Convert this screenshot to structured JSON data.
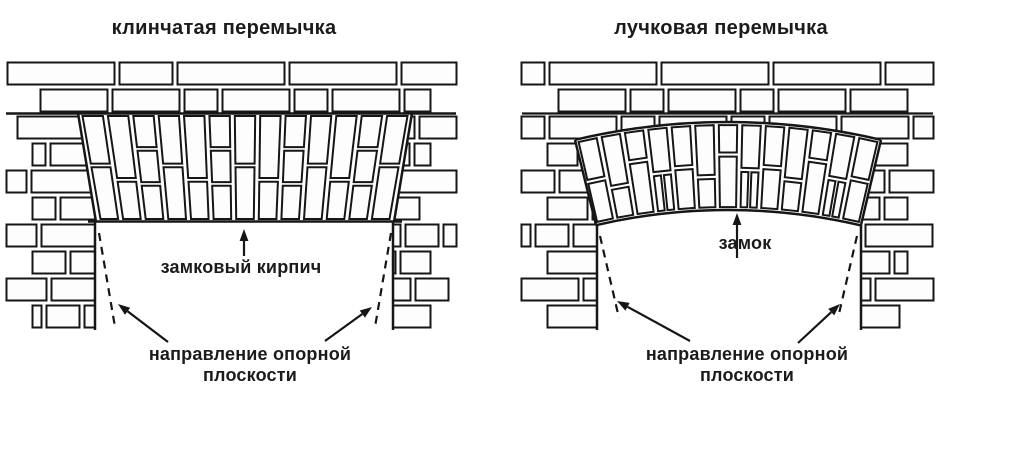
{
  "figure": {
    "background": "#ffffff",
    "line_color": "#161616",
    "brick_fill": "#fdfdfd",
    "text_color": "#1b1b1b"
  },
  "panels": [
    {
      "id": "wedge",
      "title": "клинчатая перемычка",
      "keystone_label": "замковый кирпич",
      "bearing_label": "направление опорной плоскости"
    },
    {
      "id": "segmental",
      "title": "лучковая перемычка",
      "keystone_label": "замок",
      "bearing_label": "направление опорной плоскости"
    }
  ]
}
